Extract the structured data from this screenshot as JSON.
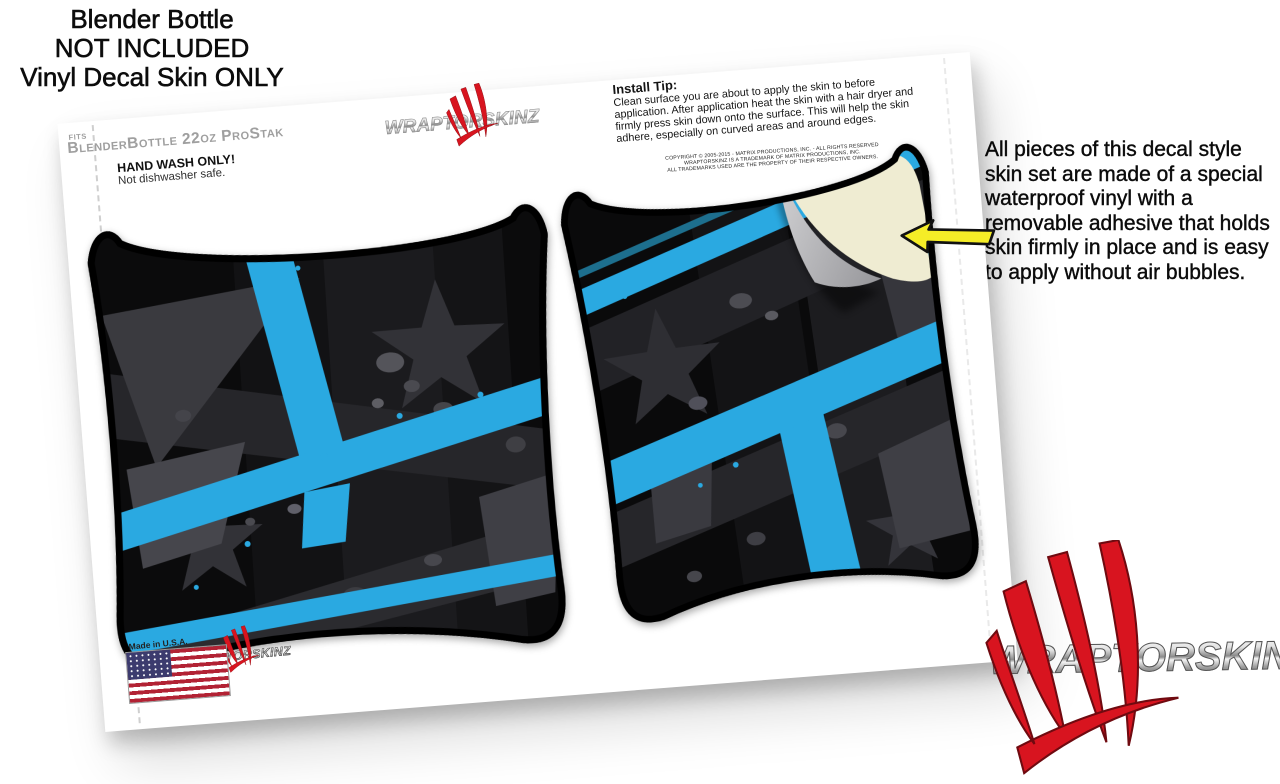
{
  "theme": {
    "accent_blue": "#2aa9e1",
    "brand_red": "#d8141f",
    "backing_cream": "#efecd2",
    "arrow_yellow": "#f5ed27",
    "panel_black": "#0b0b0c"
  },
  "caption": {
    "lines": [
      "Blender Bottle",
      "NOT INCLUDED",
      "Vinyl Decal Skin ONLY"
    ]
  },
  "sheet": {
    "fits_prefix": "FITS",
    "fits_model": "BlenderBottle 22oz ProStak",
    "hand_wash_title": "HAND WASH ONLY!",
    "hand_wash_sub": "Not dishwasher safe.",
    "install_tip_title": "Install Tip:",
    "install_tip_body": "Clean surface you are about to apply the skin to before application. After application heat the skin with a hair dryer and firmly press skin down onto the surface. This will help the skin adhere, especially on curved areas and around edges.",
    "copyright_lines": [
      "COPYRIGHT © 2005-2015 - MATRIX PRODUCTIONS, INC. - ALL RIGHTS RESERVED",
      "WRAPTORSKINZ IS A TRADEMARK OF MATRIX PRODUCTIONS, INC.",
      "ALL TRADEMARKS USED ARE THE PROPERTY OF THEIR RESPECTIVE OWNERS."
    ],
    "made_in": "Made in U.S.A."
  },
  "note": {
    "text": "All pieces of this decal style skin set are made of a special waterproof vinyl with a removable adhesive that holds skin firmly in place and is easy to apply without air bubbles."
  },
  "brand": {
    "name": "WraptorSkinz",
    "logo_text": "WraptorSkinz"
  }
}
